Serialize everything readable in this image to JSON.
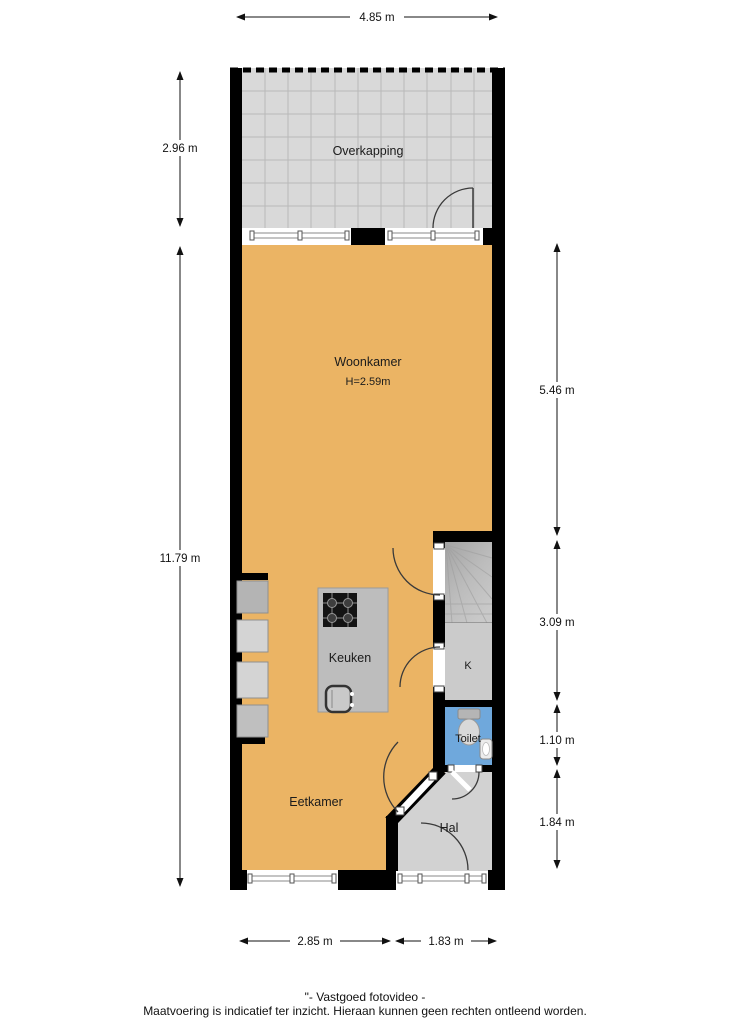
{
  "plan": {
    "rooms": {
      "overkapping": "Overkapping",
      "woonkamer": "Woonkamer",
      "woonkamer_height": "H=2.59m",
      "keuken": "Keuken",
      "eetkamer": "Eetkamer",
      "hal": "Hal",
      "toilet": "Toilet",
      "kast": "K"
    },
    "colors": {
      "floor_main": "#ebb464",
      "floor_overkapping": "#d9d9d9",
      "floor_hal": "#d2d2d2",
      "floor_toilet": "#6fa8dc",
      "floor_closet": "#cbcbcb",
      "island": "#bdbdbd",
      "wall": "#000000"
    },
    "dimensions": {
      "top_width": "4.85 m",
      "left_overkapping": "2.96 m",
      "left_total": "11.79 m",
      "right_woonkamer": "5.46 m",
      "right_stairs": "3.09 m",
      "right_toilet": "1.10 m",
      "right_hal": "1.84 m",
      "bottom_eetkamer": "2.85 m",
      "bottom_hal": "1.83 m"
    }
  },
  "footer": {
    "credit": "\"- Vastgoed fotovideo -",
    "disclaimer": "Maatvoering is indicatief ter inzicht. Hieraan kunnen geen rechten ontleend worden."
  }
}
